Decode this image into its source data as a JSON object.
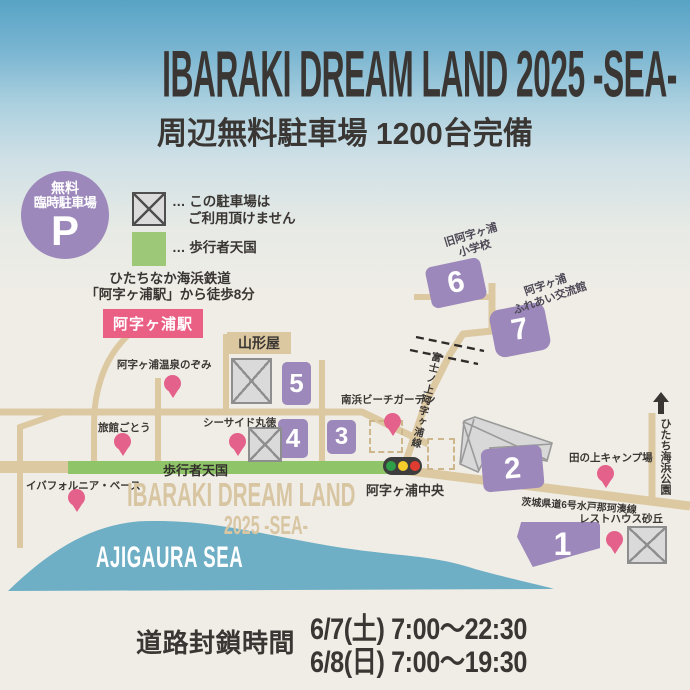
{
  "header": {
    "title": "IBARAKI DREAM LAND 2025 -SEA-",
    "subtitle": "周辺無料駐車場 1200台完備"
  },
  "badge": {
    "line1": "無料",
    "line2": "臨時駐車場",
    "p": "P"
  },
  "legend": {
    "no_parking_prefix": "…",
    "no_parking_line1": " この駐車場は",
    "no_parking_line2": "ご利用頂けません",
    "pedestrian_prefix": "…",
    "pedestrian_label": " 歩行者天国"
  },
  "access": {
    "line1": "ひたちなか海浜鉄道",
    "line2": "「阿字ヶ浦駅」から徒歩8分",
    "station": "阿字ヶ浦駅"
  },
  "map": {
    "yamagataya": "山形屋",
    "school_line1": "旧阿字ヶ浦",
    "school_line2": "小学校",
    "fureai_line1": "阿字ヶ浦",
    "fureai_line2": "ふれあい交流館",
    "road_b_label": "富士ノ上阿字ヶ浦線",
    "crossing_label": "阿字ヶ浦中央",
    "route6_label": "茨城県道6号水戸那珂湊線",
    "park_label": "ひたち海浜公園",
    "pedestrian_road_label": "歩行者天国",
    "watermark_line1": "IBARAKI DREAM LAND",
    "watermark_line2": "2025 -SEA-",
    "sea_label": "AJIGAURA SEA",
    "lots": [
      {
        "num": "1"
      },
      {
        "num": "2"
      },
      {
        "num": "3"
      },
      {
        "num": "4"
      },
      {
        "num": "5"
      },
      {
        "num": "6"
      },
      {
        "num": "7"
      }
    ],
    "pois": [
      {
        "label": "阿字ヶ浦温泉のぞみ"
      },
      {
        "label": "旅館ごとう"
      },
      {
        "label": "シーサイド丸徳"
      },
      {
        "label": "南浜ビーチガーデン"
      },
      {
        "label": "田の上キャンプ場"
      },
      {
        "label": "レストハウス砂丘"
      },
      {
        "label": "イバフォルニア・ベース"
      }
    ]
  },
  "closure": {
    "label": "道路封鎖時間",
    "line1": "6/7(土)  7:00～22:30",
    "line2": "6/8(日)  7:00～19:30"
  },
  "colors": {
    "accent_purple": "#9c88ba",
    "accent_pink": "#ea5f84",
    "pin_pink": "#e3618a",
    "road_tan": "#dcc9a1",
    "pedestrian_green": "#8fc468",
    "sea_blue": "#6fafc5",
    "text_dark": "#3a3633",
    "signal_green": "#2f9e49",
    "signal_yellow": "#f4cf2b",
    "signal_red": "#e03c30"
  }
}
